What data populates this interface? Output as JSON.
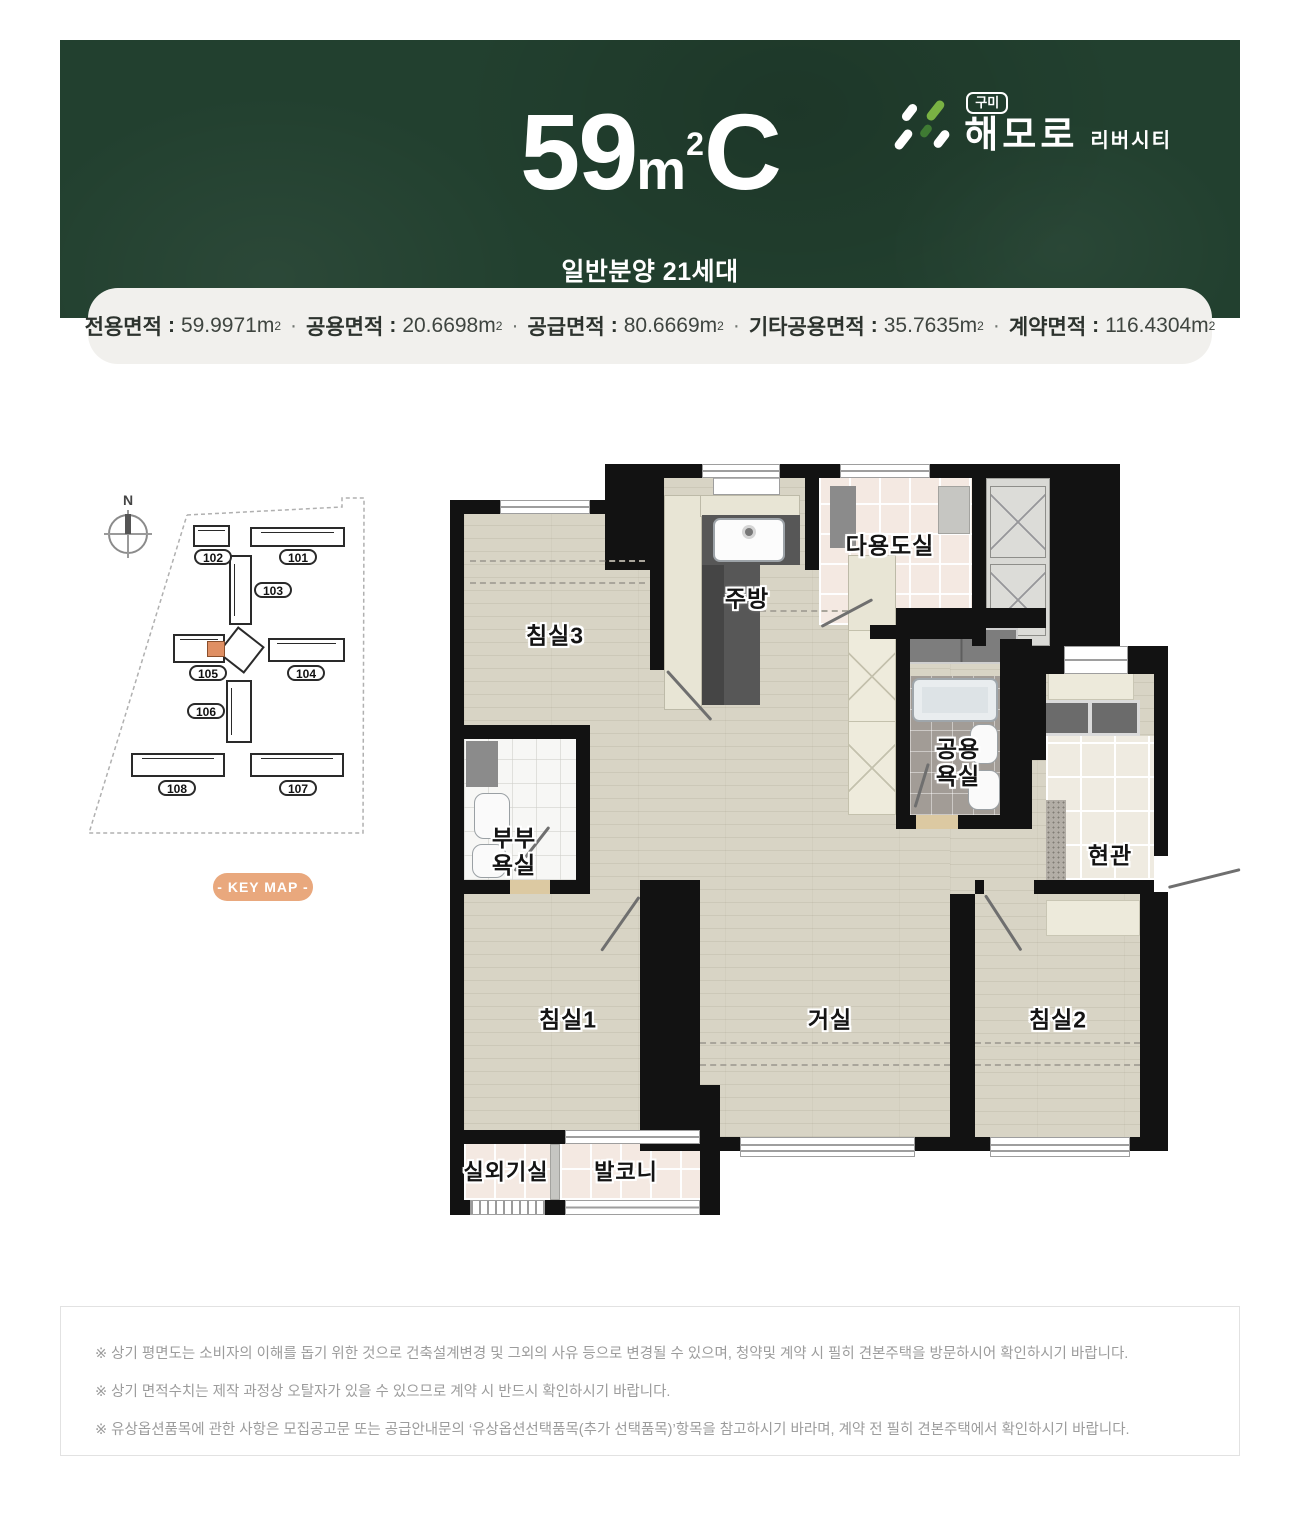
{
  "header": {
    "unit_size": "59",
    "unit_measure": "m",
    "unit_sup": "2",
    "unit_type": "C",
    "subtitle": "일반분양 21세대",
    "logo": {
      "city": "구미",
      "brand": "해모로",
      "suffix": "리버시티"
    }
  },
  "area_info": {
    "colon": ":",
    "separator": "·",
    "unit": "m",
    "unit_sup": "2",
    "items": [
      {
        "label": "전용면적",
        "value": "59.9971"
      },
      {
        "label": "공용면적",
        "value": "20.6698"
      },
      {
        "label": "공급면적",
        "value": "80.6669"
      },
      {
        "label": "기타공용면적",
        "value": "35.7635"
      },
      {
        "label": "계약면적",
        "value": "116.4304"
      }
    ]
  },
  "keymap": {
    "compass": "N",
    "badge": "- KEY MAP -",
    "building_labels": [
      "102",
      "101",
      "103",
      "105",
      "104",
      "106",
      "108",
      "107"
    ]
  },
  "floorplan": {
    "bedroom3": "침실3",
    "kitchen": "주방",
    "utility": "다용도실",
    "shared_bath_1": "공용",
    "shared_bath_2": "욕실",
    "entrance": "현관",
    "master_bath_1": "부부",
    "master_bath_2": "욕실",
    "bedroom1": "침실1",
    "living": "거실",
    "bedroom2": "침실2",
    "ac_room": "실외기실",
    "balcony": "발코니"
  },
  "notes": [
    "※ 상기 평면도는 소비자의 이해를 돕기 위한 것으로 건축설계변경 및 그외의 사유 등으로 변경될 수 있으며, 청약및 계약 시 필히 견본주택을 방문하시어 확인하시기 바랍니다.",
    "※ 상기 면적수치는 제작 과정상 오탈자가 있을 수 있으므로 계약 시 반드시 확인하시기 바랍니다.",
    "※ 유상옵션품목에 관한 사항은 모집공고문 또는 공급안내문의 ‘유상옵션선택품목(추가 선택품목)’항목을 참고하시기 바라며, 계약 전 필히 견본주택에서 확인하시기 바랍니다."
  ],
  "colors": {
    "header_green": "#22402f",
    "badge_salmon": "#e9a87d",
    "highlight_unit": "#df8f63",
    "logo_green": "#79b243"
  }
}
